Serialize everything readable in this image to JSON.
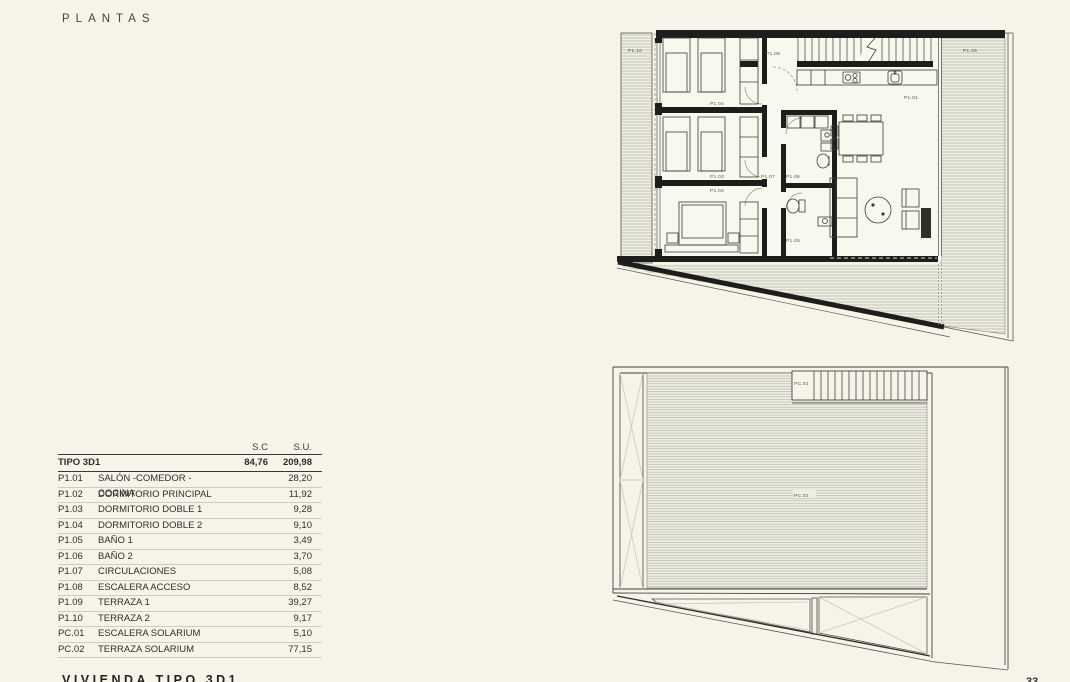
{
  "page": {
    "title": "PLANTAS",
    "footer_text": "VIVIENDA TIPO 3D1",
    "page_number": "33",
    "bg_color": "#f6f4e9",
    "line_color": "#1d1d1b"
  },
  "table": {
    "col_headers": {
      "sc": "S.C",
      "su": "S.U."
    },
    "summary_row": {
      "label": "TIPO 3D1",
      "sc": "84,76",
      "su": "209,98"
    },
    "rows": [
      {
        "code": "P1.01",
        "name": "SALÓN -COMEDOR - COCINA",
        "value": "28,20"
      },
      {
        "code": "P1.02",
        "name": "DORMITORIO PRINCIPAL",
        "value": "11,92"
      },
      {
        "code": "P1.03",
        "name": "DORMITORIO DOBLE 1",
        "value": "9,28"
      },
      {
        "code": "P1.04",
        "name": "DORMITORIO DOBLE 2",
        "value": "9,10"
      },
      {
        "code": "P1.05",
        "name": "BAÑO 1",
        "value": "3,49"
      },
      {
        "code": "P1.06",
        "name": "BAÑO 2",
        "value": "3,70"
      },
      {
        "code": "P1.07",
        "name": "CIRCULACIONES",
        "value": "5,08"
      },
      {
        "code": "P1.08",
        "name": "ESCALERA ACCESO",
        "value": "8,52"
      },
      {
        "code": "P1.09",
        "name": "TERRAZA 1",
        "value": "39,27"
      },
      {
        "code": "P1.10",
        "name": "TERRAZA 2",
        "value": "9,17"
      },
      {
        "code": "PC.01",
        "name": "ESCALERA SOLARIUM",
        "value": "5,10"
      },
      {
        "code": "PC.02",
        "name": "TERRAZA SOLARIUM",
        "value": "77,15"
      }
    ]
  },
  "floor_plan": {
    "labels": {
      "p101": "P1.01",
      "p102": "P1.02",
      "p103": "P1.03",
      "p104": "P1.04",
      "p105": "P1.05",
      "p106": "P1.06",
      "p107": "P1.07",
      "p108": "P1.08",
      "p109": "P1.09",
      "p110": "P1.10",
      "pc01": "PC.01",
      "pc02": "PC.02"
    }
  }
}
